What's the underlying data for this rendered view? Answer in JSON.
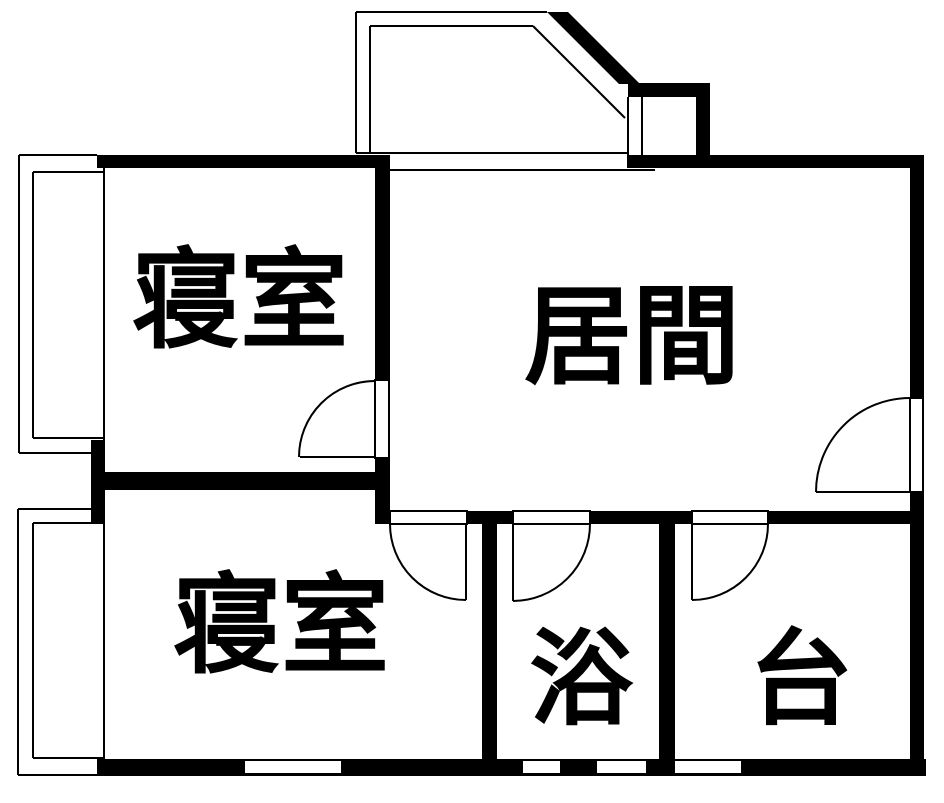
{
  "title": "apartment-floor-plan",
  "colors": {
    "wall": "#000000",
    "background": "#ffffff"
  },
  "rooms": [
    {
      "id": "bedroom-top",
      "label": "寝室"
    },
    {
      "id": "living-room",
      "label": "居間"
    },
    {
      "id": "bedroom-bottom",
      "label": "寝室"
    },
    {
      "id": "bath",
      "label": "浴"
    },
    {
      "id": "kitchen",
      "label": "台"
    }
  ]
}
